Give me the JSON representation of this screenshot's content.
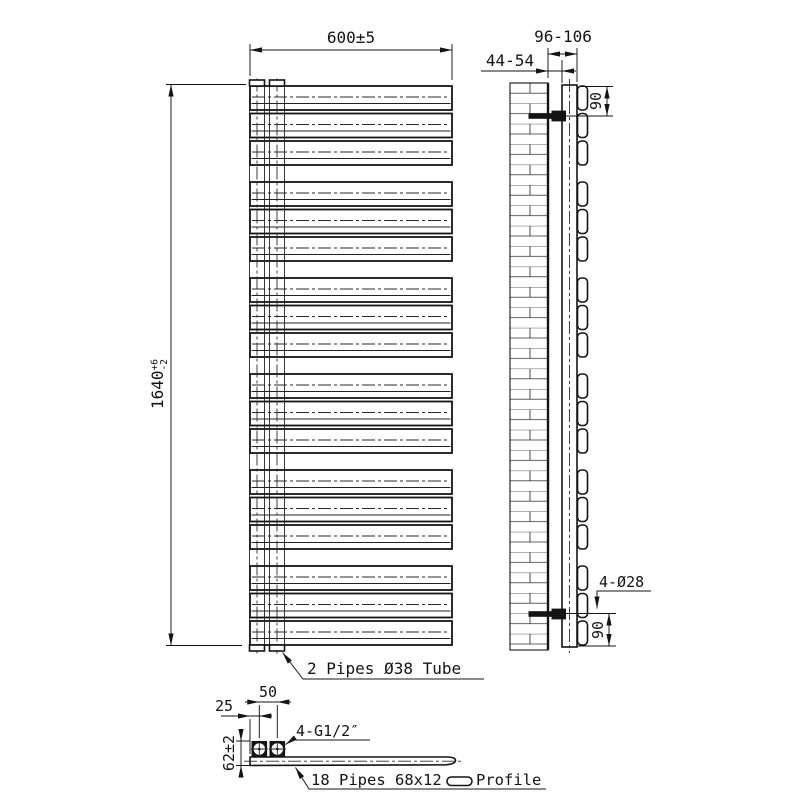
{
  "front_view": {
    "width_dim": "600±5",
    "height_dim": {
      "value": "1640",
      "tol_upper": "+6",
      "tol_lower": "-2"
    },
    "pipes_label": "2 Pipes Ø38 Tube",
    "panel_groups": 6,
    "panels_per_group": 3
  },
  "side_view": {
    "wall_gap_dim": "44-54",
    "overall_depth_dim": "96-106",
    "top_bracket_dim": "90",
    "bottom_bracket_dim": "90",
    "holes_label": "4-Ø28"
  },
  "bottom_view": {
    "end_offset_dim": "25",
    "pipe_spacing_dim": "50",
    "thread_label": "4-G1/2″",
    "depth_dim": "62±2",
    "profile_label_prefix": "18 Pipes 68x12",
    "profile_label_suffix": "Profile"
  },
  "colors": {
    "line": "#141414",
    "background": "#ffffff"
  }
}
